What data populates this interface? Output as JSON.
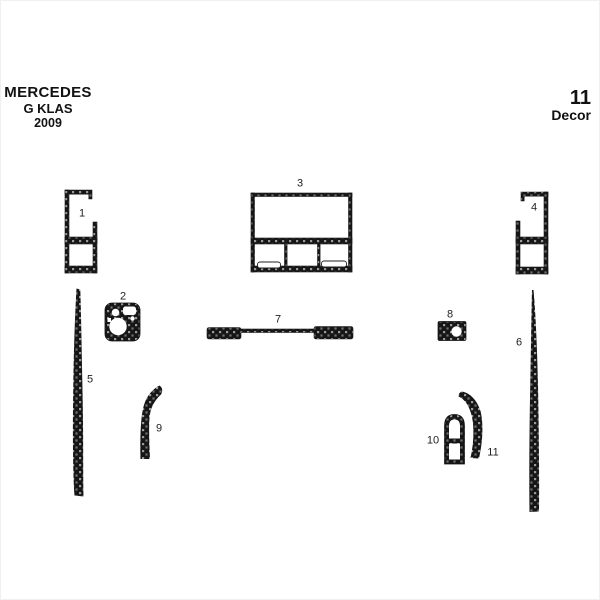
{
  "header": {
    "brand": "MERCEDES",
    "model": "G KLAS",
    "year": "2009",
    "piece_count": "11",
    "piece_count_word": "Decor"
  },
  "pieces": [
    {
      "label": "1"
    },
    {
      "label": "2"
    },
    {
      "label": "3"
    },
    {
      "label": "4"
    },
    {
      "label": "5"
    },
    {
      "label": "6"
    },
    {
      "label": "7"
    },
    {
      "label": "8"
    },
    {
      "label": "9"
    },
    {
      "label": "10"
    },
    {
      "label": "11"
    }
  ],
  "colors": {
    "background": "#ffffff",
    "text": "#111111",
    "carbon_base": "#161616",
    "carbon_fleck_light": "#9a9a9a",
    "carbon_fleck_dark": "#6f6f6f"
  }
}
